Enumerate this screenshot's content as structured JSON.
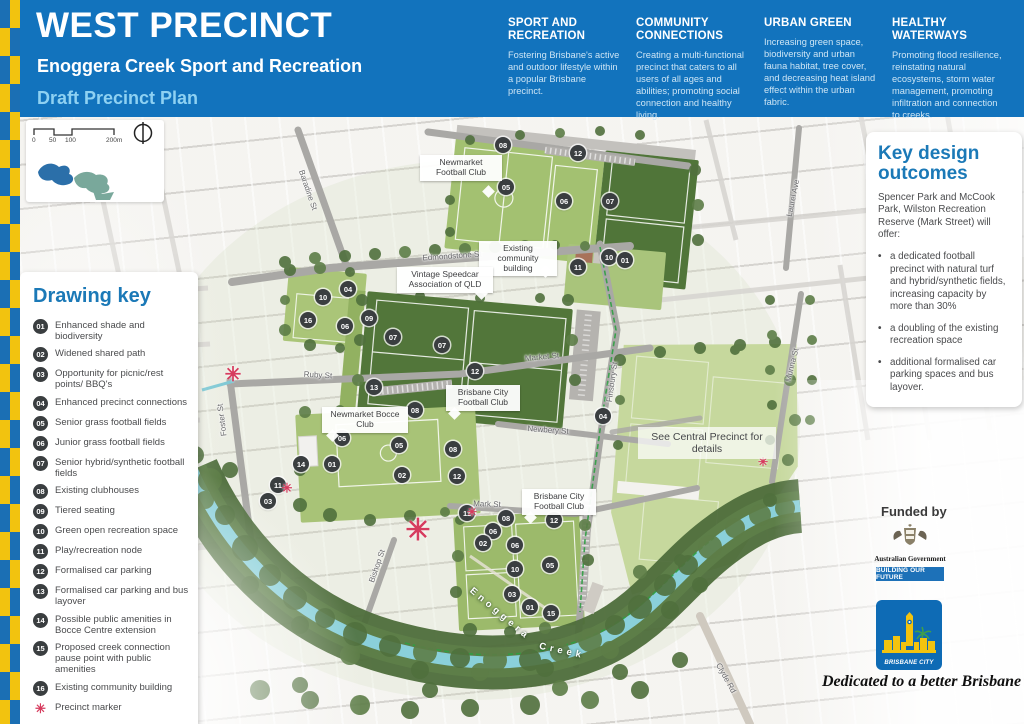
{
  "header": {
    "title": "WEST PRECINCT",
    "subtitle": "Enoggera Creek Sport and Recreation",
    "plan_label": "Draft Precinct Plan",
    "pillars": [
      {
        "heading": "SPORT AND RECREATION",
        "body": "Fostering Brisbane's active and outdoor lifestyle within a popular Brisbane precinct."
      },
      {
        "heading": "COMMUNITY CONNECTIONS",
        "body": "Creating a multi-functional precinct that caters to all users of all ages and abilities; promoting social connection and healthy living."
      },
      {
        "heading": "URBAN GREEN",
        "body": "Increasing green space, biodiversity and urban fauna habitat, tree cover, and decreasing heat island effect within the urban fabric."
      },
      {
        "heading": "HEALTHY WATERWAYS",
        "body": "Promoting flood resilience, reinstating natural ecosystems, storm water management, promoting infiltration and connection to creeks."
      }
    ]
  },
  "scale_bar": {
    "labels": [
      "0",
      "50",
      "100",
      "200m"
    ]
  },
  "drawing_key": {
    "title": "Drawing key",
    "items": [
      {
        "num": "01",
        "label": "Enhanced shade and biodiversity"
      },
      {
        "num": "02",
        "label": "Widened shared path"
      },
      {
        "num": "03",
        "label": "Opportunity for picnic/rest points/ BBQ's"
      },
      {
        "num": "04",
        "label": "Enhanced precinct connections"
      },
      {
        "num": "05",
        "label": "Senior grass football fields"
      },
      {
        "num": "06",
        "label": "Junior grass football fields"
      },
      {
        "num": "07",
        "label": "Senior hybrid/synthetic football fields"
      },
      {
        "num": "08",
        "label": "Existing clubhouses"
      },
      {
        "num": "09",
        "label": "Tiered seating"
      },
      {
        "num": "10",
        "label": "Green open recreation space"
      },
      {
        "num": "11",
        "label": "Play/recreation node"
      },
      {
        "num": "12",
        "label": "Formalised car parking"
      },
      {
        "num": "13",
        "label": "Formalised car parking and bus layover"
      },
      {
        "num": "14",
        "label": "Possible public amenities in Bocce Centre extension"
      },
      {
        "num": "15",
        "label": "Proposed creek connection pause point with public amenities"
      },
      {
        "num": "16",
        "label": "Existing community building"
      }
    ],
    "marker_label": "Precinct marker"
  },
  "outcomes": {
    "title": "Key design outcomes",
    "intro": "Spencer Park and McCook Park, Wilston Recreation Reserve (Mark Street) will offer:",
    "bullets": [
      "a dedicated football precinct with natural turf and hybrid/synthetic fields, increasing capacity by more than 30%",
      "a doubling of the existing recreation space",
      "additional formalised car parking spaces and bus layover."
    ]
  },
  "map": {
    "marker_glyph": "✳",
    "street_labels": [
      {
        "text": "Baradine St",
        "x": 308,
        "y": 190,
        "rot": 71
      },
      {
        "text": "Edmondstone St",
        "x": 452,
        "y": 256,
        "rot": -4
      },
      {
        "text": "Market St",
        "x": 542,
        "y": 357,
        "rot": -5
      },
      {
        "text": "Ruby St",
        "x": 318,
        "y": 375,
        "rot": 3
      },
      {
        "text": "Newbery St",
        "x": 548,
        "y": 430,
        "rot": 4
      },
      {
        "text": "Mark St",
        "x": 487,
        "y": 504,
        "rot": 2
      },
      {
        "text": "Foster St",
        "x": 222,
        "y": 420,
        "rot": -97
      },
      {
        "text": "Bishop St",
        "x": 377,
        "y": 566,
        "rot": -71
      },
      {
        "text": "Finsbury St",
        "x": 612,
        "y": 382,
        "rot": -82
      },
      {
        "text": "Munna St",
        "x": 792,
        "y": 365,
        "rot": -76
      },
      {
        "text": "Laurel Ave",
        "x": 793,
        "y": 198,
        "rot": -78
      },
      {
        "text": "Clyde Rd",
        "x": 726,
        "y": 678,
        "rot": 61
      },
      {
        "text": "Enoggera",
        "x": 500,
        "y": 614,
        "rot": 40,
        "cls": "creek"
      },
      {
        "text": "Creek",
        "x": 562,
        "y": 651,
        "rot": 12,
        "cls": "creek"
      }
    ],
    "place_labels": [
      {
        "text": "Newmarket Football Club",
        "x": 420,
        "y": 155,
        "w": 74,
        "tail": [
          64,
          32
        ]
      },
      {
        "text": "Existing community building",
        "x": 479,
        "y": 241,
        "w": 70,
        "tail": [
          62,
          26
        ]
      },
      {
        "text": "Vintage Speedcar Association of QLD",
        "x": 397,
        "y": 267,
        "w": 88,
        "tail": [
          80,
          22
        ]
      },
      {
        "text": "Brisbane City Football Club",
        "x": 446,
        "y": 385,
        "w": 66,
        "tail": [
          4,
          24
        ]
      },
      {
        "text": "Newmarket Bocce Club",
        "x": 322,
        "y": 407,
        "w": 78,
        "tail": [
          6,
          24
        ]
      },
      {
        "text": "Brisbane City Football Club",
        "x": 522,
        "y": 489,
        "w": 66,
        "tail": [
          4,
          24
        ]
      },
      {
        "text": "See Central Precinct for details",
        "x": 638,
        "y": 427,
        "w": 124,
        "tail": null,
        "ghost": true
      }
    ],
    "badges": [
      {
        "n": "08",
        "x": 503,
        "y": 145
      },
      {
        "n": "12",
        "x": 578,
        "y": 153
      },
      {
        "n": "05",
        "x": 506,
        "y": 187
      },
      {
        "n": "06",
        "x": 564,
        "y": 201
      },
      {
        "n": "07",
        "x": 610,
        "y": 201
      },
      {
        "n": "10",
        "x": 609,
        "y": 257
      },
      {
        "n": "01",
        "x": 625,
        "y": 260
      },
      {
        "n": "11",
        "x": 578,
        "y": 267
      },
      {
        "n": "10",
        "x": 323,
        "y": 297
      },
      {
        "n": "04",
        "x": 348,
        "y": 289
      },
      {
        "n": "16",
        "x": 308,
        "y": 320
      },
      {
        "n": "09",
        "x": 369,
        "y": 318
      },
      {
        "n": "06",
        "x": 345,
        "y": 326
      },
      {
        "n": "07",
        "x": 393,
        "y": 337
      },
      {
        "n": "07",
        "x": 442,
        "y": 345
      },
      {
        "n": "12",
        "x": 475,
        "y": 371
      },
      {
        "n": "13",
        "x": 374,
        "y": 387
      },
      {
        "n": "08",
        "x": 415,
        "y": 410
      },
      {
        "n": "06",
        "x": 342,
        "y": 438
      },
      {
        "n": "05",
        "x": 399,
        "y": 445
      },
      {
        "n": "08",
        "x": 453,
        "y": 449
      },
      {
        "n": "14",
        "x": 301,
        "y": 464
      },
      {
        "n": "01",
        "x": 332,
        "y": 464
      },
      {
        "n": "02",
        "x": 402,
        "y": 475
      },
      {
        "n": "12",
        "x": 457,
        "y": 476
      },
      {
        "n": "11",
        "x": 278,
        "y": 485
      },
      {
        "n": "03",
        "x": 268,
        "y": 501
      },
      {
        "n": "04",
        "x": 603,
        "y": 416
      },
      {
        "n": "11",
        "x": 467,
        "y": 513
      },
      {
        "n": "08",
        "x": 506,
        "y": 518
      },
      {
        "n": "12",
        "x": 554,
        "y": 520
      },
      {
        "n": "06",
        "x": 493,
        "y": 531
      },
      {
        "n": "02",
        "x": 483,
        "y": 543
      },
      {
        "n": "06",
        "x": 515,
        "y": 545
      },
      {
        "n": "05",
        "x": 550,
        "y": 565
      },
      {
        "n": "10",
        "x": 515,
        "y": 569
      },
      {
        "n": "03",
        "x": 512,
        "y": 594
      },
      {
        "n": "01",
        "x": 530,
        "y": 607
      },
      {
        "n": "15",
        "x": 551,
        "y": 613
      }
    ],
    "markers": [
      {
        "x": 233,
        "y": 375,
        "s": 20
      },
      {
        "x": 287,
        "y": 488,
        "s": 13
      },
      {
        "x": 418,
        "y": 531,
        "s": 30
      },
      {
        "x": 472,
        "y": 512,
        "s": 12
      },
      {
        "x": 763,
        "y": 462,
        "s": 12
      }
    ]
  },
  "funding": {
    "funded_by": "Funded by",
    "gov_name": "Australian Government",
    "gov_tagline": "BUILDING OUR FUTURE",
    "council_name": "BRISBANE CITY",
    "motto": "Dedicated to a better Brisbane"
  },
  "colors": {
    "header_blue": "#1273BD",
    "accent_yellow": "#F2C30F",
    "heading_blue": "#1B79B7",
    "badge_dark": "#3A3E40",
    "marker_red": "#D63C5E",
    "synthetic_field_green": "#52763A",
    "grass_field_green": "#A3C171",
    "central_precinct_green": "#C6D89D",
    "creek_teal": "#8AD0DA"
  }
}
